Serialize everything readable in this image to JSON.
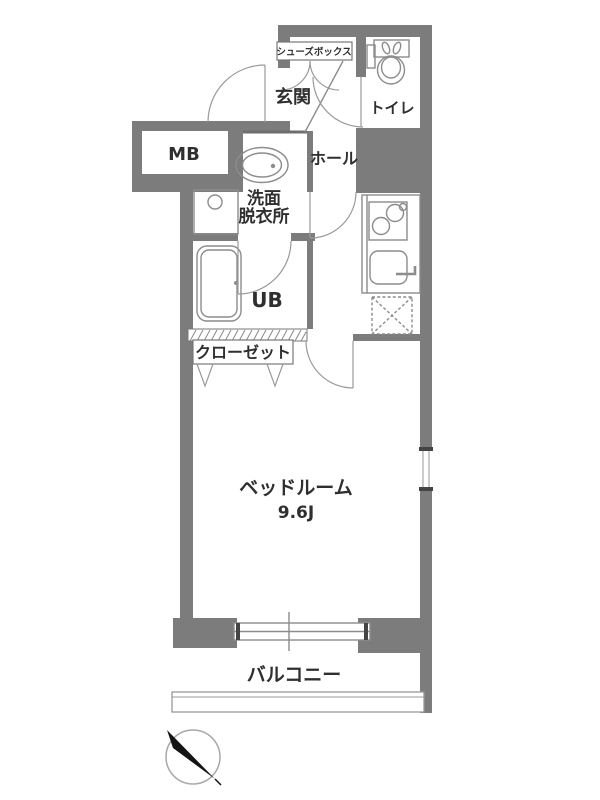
{
  "plan": {
    "labels": {
      "shoe_box": "シューズボックス",
      "entrance": "玄関",
      "toilet": "トイレ",
      "meter_box": "MB",
      "hall": "ホール",
      "washroom_line1": "洗面",
      "washroom_line2": "脱衣所",
      "unit_bath": "UB",
      "closet": "クローゼット",
      "bedroom": "ベッドルーム",
      "bedroom_size": "9.6J",
      "balcony": "バルコニー"
    },
    "icons": {
      "toilet": "toilet-top-view",
      "washbasin": "oval-washbasin",
      "washing_machine": "washing-machine-pan",
      "bathtub": "bathtub",
      "stove": "two-burner-stove",
      "kitchen_sink": "kitchen-sink-with-faucet",
      "refrigerator": "refrigerator-space-dashed-x",
      "compass": "north-arrow-compass"
    },
    "colors": {
      "wall": "#7c7c7c",
      "fixture_line": "#8c8c8c",
      "text": "#2f2f2f",
      "background": "#ffffff",
      "compass_needle": "#141414"
    }
  }
}
